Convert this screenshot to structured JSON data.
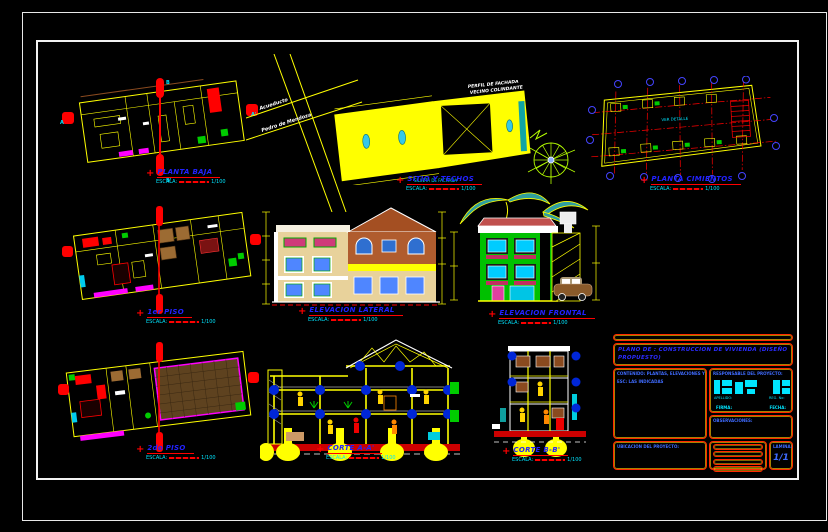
{
  "sheet": {
    "background": "#000000",
    "frame_color": "#ffffff"
  },
  "colors": {
    "accent_yellow": "#ffff00",
    "accent_red": "#ff0000",
    "label_blue": "#2222ff",
    "scale_cyan": "#00e5ff",
    "site_fill": "#ffff00"
  },
  "scale_note": {
    "label": "ESCALA:",
    "value": "1/100"
  },
  "drawings": {
    "planta_baja": {
      "title": "PLANTA BAJA",
      "markers": {
        "left": "A",
        "right": "A'",
        "top": "B",
        "bottom": "B'"
      }
    },
    "sitio_techos": {
      "title": "SITIO Y TECHOS",
      "street_1": "Acueducto",
      "street_2": "Pedro de Mendoza",
      "neighbor_note_1": "PERFIL DE FACHADA",
      "neighbor_note_2": "VECINO COLINDANTE",
      "silhouette_note": "SILUETA DE FACHADA"
    },
    "planta_cimientos": {
      "title": "PLANTA CIMIENTOS",
      "note": "VER DETALLE"
    },
    "primer_piso": {
      "title": "1er PISO"
    },
    "elevacion_lateral": {
      "title": "ELEVACION LATERAL"
    },
    "elevacion_frontal": {
      "title": "ELEVACION FRONTAL"
    },
    "segundo_piso": {
      "title": "2do PISO"
    },
    "corte_aa": {
      "title": "CORTE A-A'"
    },
    "corte_bb": {
      "title": "CORTE B-B'"
    }
  },
  "title_block": {
    "plano_title": "PLANO DE : CONSTRUCCION DE VIVIENDA (DISEÑO PROPUESTO)",
    "left_box_line1": "CONTENIDO: PLANTAS, ELEVACIONES Y CORTES",
    "left_box_line2": "ESC: LAS INDICADAS",
    "stamp": {
      "header": "RESPONSABLE DEL PROYECTO:",
      "field_left": "APELLIDO:",
      "field_right": "REG. No:",
      "footer_left": "FIRMA:",
      "footer_right": "FECHA:"
    },
    "observations": "OBSERVACIONES:",
    "notes_header": "UBICACION DEL PROYECTO:",
    "sheet": {
      "label": "LAMINA:",
      "number": "1/1"
    }
  }
}
